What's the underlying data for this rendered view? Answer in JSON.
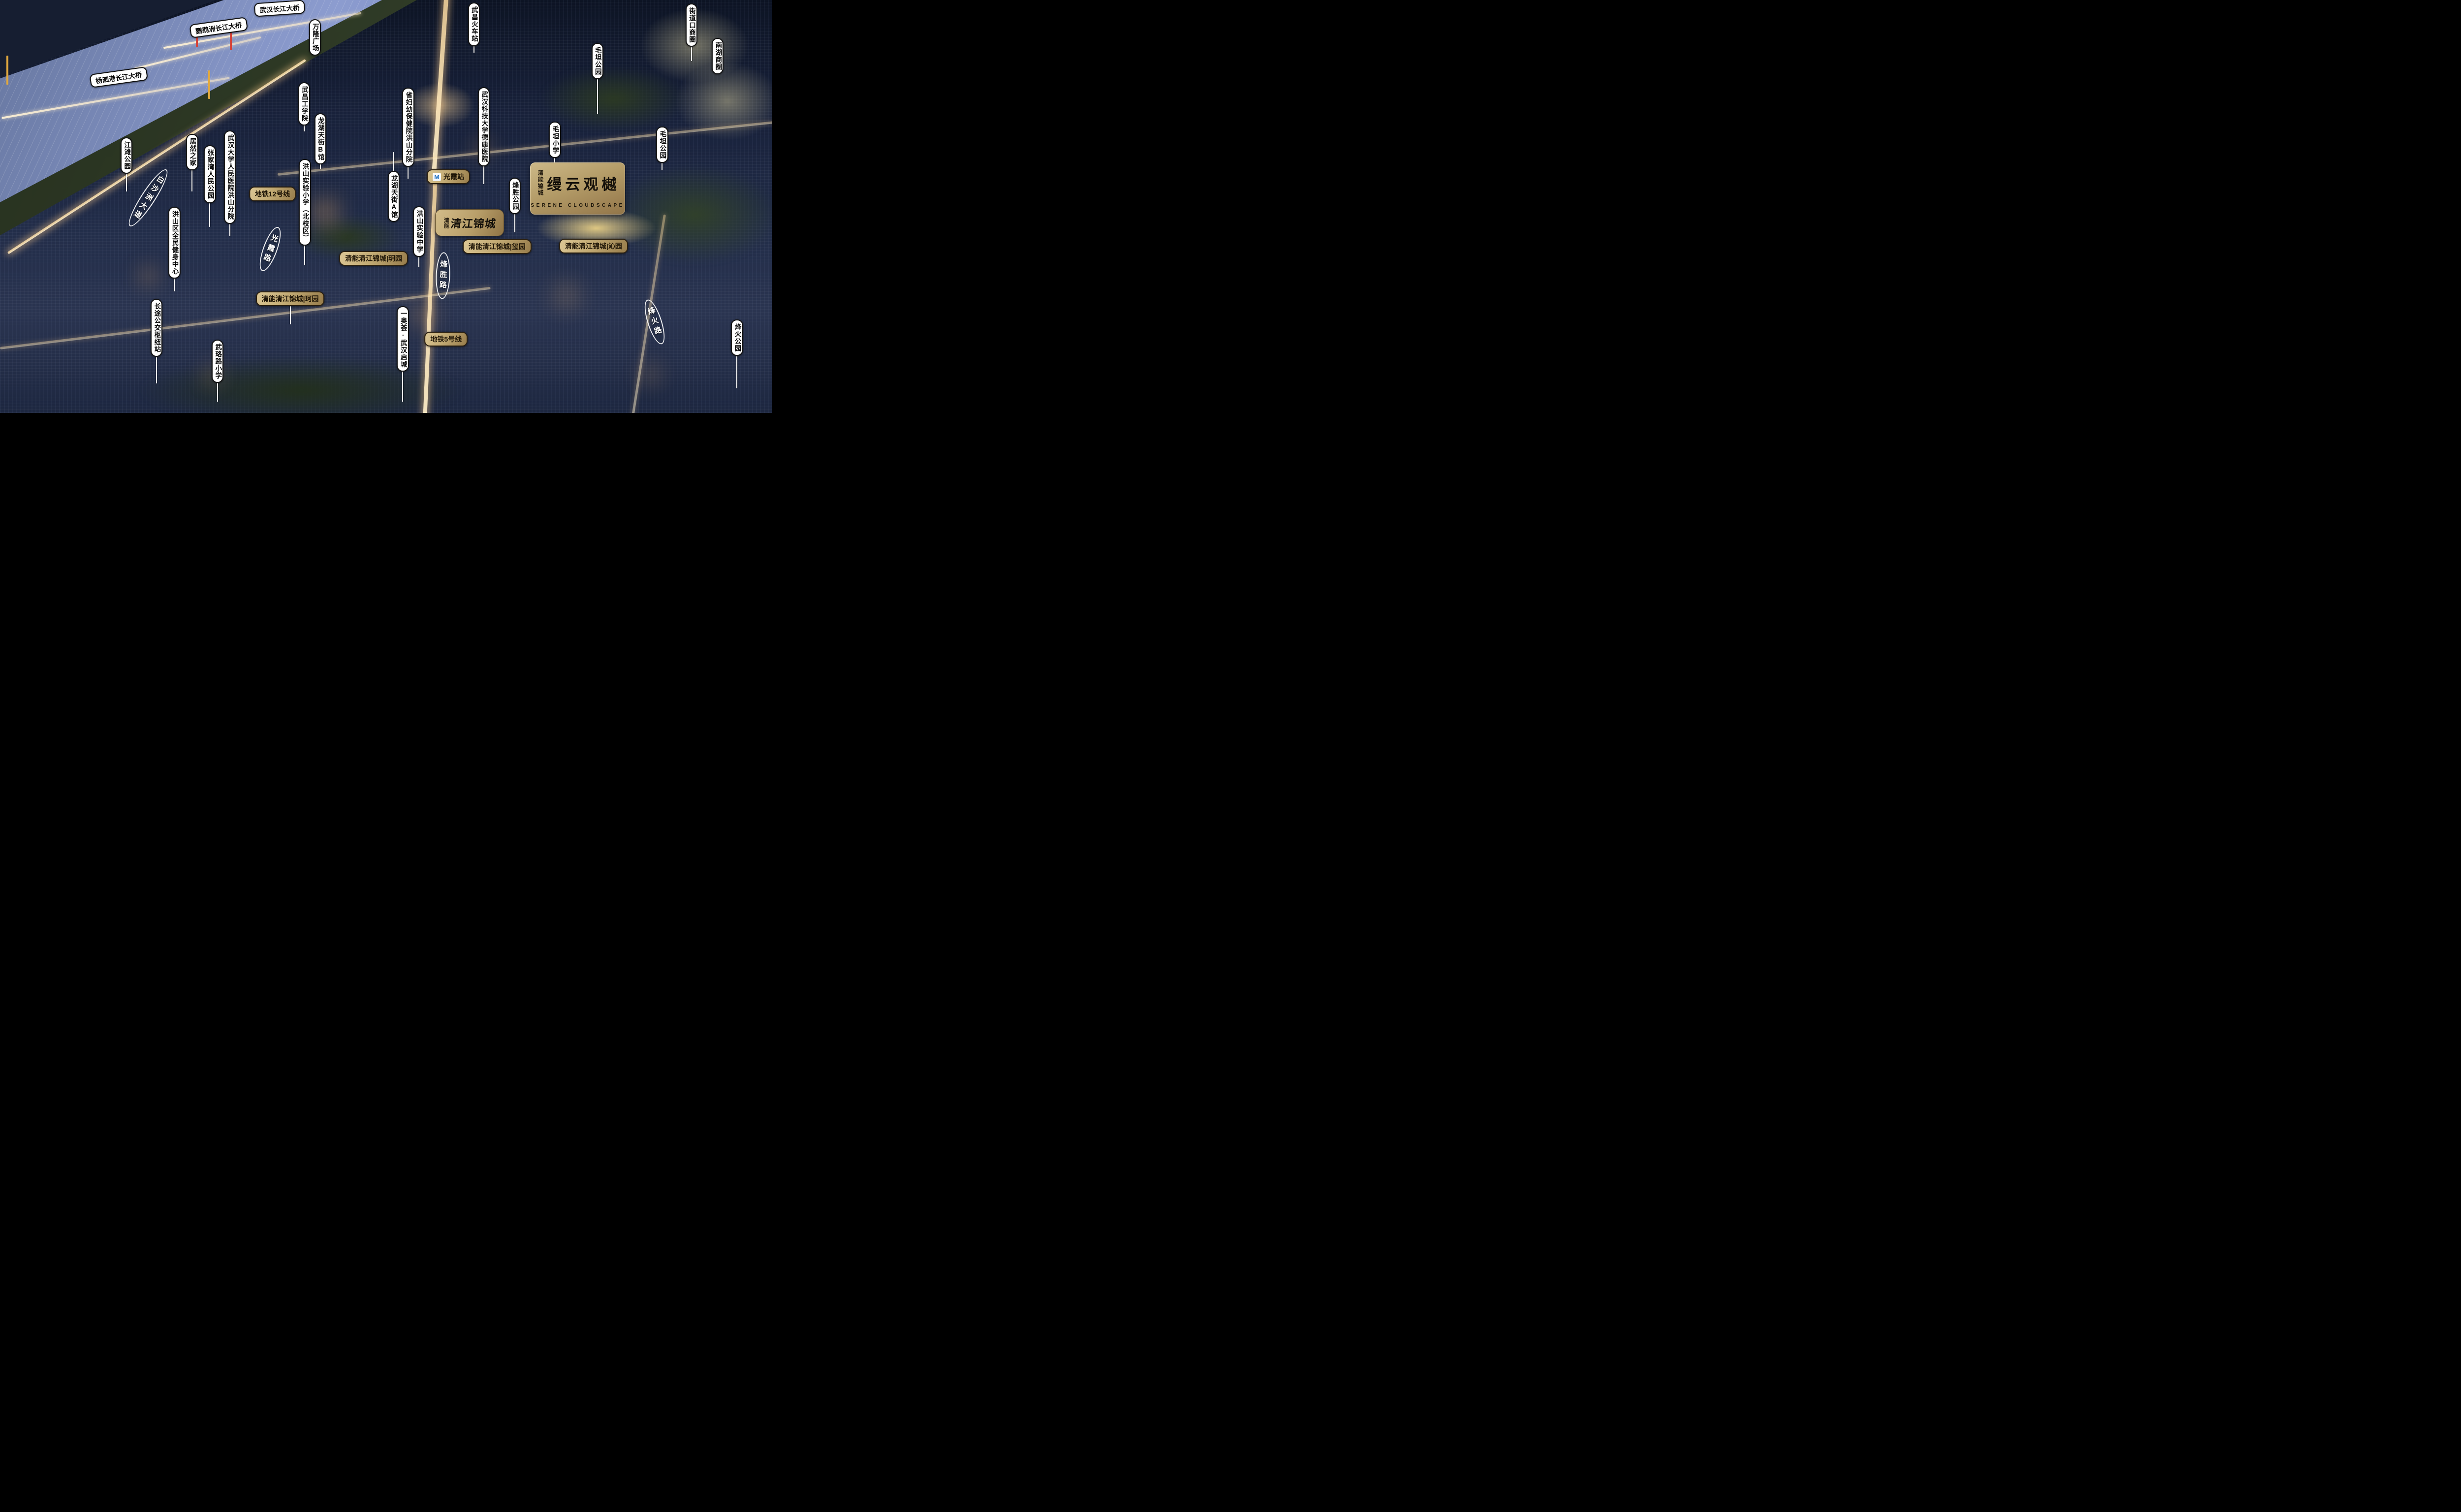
{
  "logo": {
    "seal": "清能锦城",
    "title": "缦云观樾",
    "subtitle": "SERENE CLOUDSCAPE"
  },
  "brand": {
    "prefix": "清能",
    "name": "清江锦城"
  },
  "colors": {
    "gold_light": "#dcc795",
    "gold_dark": "#977c4b",
    "pill_white": "#ffffff",
    "pill_text": "#050505",
    "metro_m_blue": "#1e6fc0",
    "road_text": "#ffffff",
    "night_city": "#1a2338",
    "river_blue": "#8c9ccf"
  },
  "metro_icon": "metro-m-icon",
  "map_labels": [
    {
      "id": "wuhan-changjiang-bridge",
      "kind": "place-h",
      "text": "武汉长江大桥",
      "x": 36.2,
      "y": 2.0,
      "rot": -4
    },
    {
      "id": "yingwuzhou-changjiang-bridge",
      "kind": "place-h",
      "text": "鹦鹉洲长江大桥",
      "x": 28.3,
      "y": 6.7,
      "rot": -8
    },
    {
      "id": "yangsigang-changjiang-bridge",
      "kind": "place-h",
      "text": "杨泗港长江大桥",
      "x": 15.4,
      "y": 18.7,
      "rot": -8
    },
    {
      "id": "wanlong-plaza",
      "kind": "place-v",
      "text": "万隆广场",
      "x": 40.8,
      "top": 4.6
    },
    {
      "id": "wuchang-railway-station",
      "kind": "place-v",
      "text": "武昌火车站",
      "x": 61.4,
      "top": 0.6,
      "leader": [
        10.9,
        12.8
      ]
    },
    {
      "id": "jiedaokou-business-circle",
      "kind": "place-v",
      "text": "街道口商圈",
      "x": 89.6,
      "top": 0.8,
      "leader": [
        11.1,
        14.8
      ]
    },
    {
      "id": "nanhu-business-circle",
      "kind": "place-v",
      "text": "南湖商圈",
      "x": 93.0,
      "top": 9.2
    },
    {
      "id": "maotan-park-north",
      "kind": "place-v",
      "text": "毛坦公园",
      "x": 77.4,
      "top": 10.4,
      "leader": [
        19.0,
        27.5
      ]
    },
    {
      "id": "maotan-primary-school",
      "kind": "place-v",
      "text": "毛坦小学",
      "x": 71.9,
      "top": 29.4,
      "leader": [
        38.0,
        41.3
      ]
    },
    {
      "id": "maotan-park-east",
      "kind": "place-v",
      "text": "毛坦公园",
      "x": 85.8,
      "top": 30.6,
      "leader": [
        39.2,
        41.3
      ]
    },
    {
      "id": "wuchang-institute-of-technology",
      "kind": "place-v",
      "text": "武昌工学院",
      "x": 39.4,
      "top": 19.9,
      "leader": [
        30.2,
        31.8
      ]
    },
    {
      "id": "longhu-paradise-walk-b",
      "kind": "place-v",
      "text": "龙湖天街B馆",
      "x": 41.5,
      "top": 27.4,
      "leader": [
        39.4,
        41.0
      ]
    },
    {
      "id": "provincial-maternity-hospital-hongshan",
      "kind": "place-v",
      "text": "省妇幼保健院洪山分院",
      "x": 52.9,
      "top": 21.2,
      "leader": [
        40.2,
        43.3
      ]
    },
    {
      "id": "wust-dekang-hospital",
      "kind": "place-v",
      "text": "武汉科技大学德康医院",
      "x": 62.7,
      "top": 21.1,
      "leader": [
        40.1,
        44.6
      ]
    },
    {
      "id": "jiangtan-park",
      "kind": "place-v",
      "text": "江滩公园",
      "x": 16.4,
      "top": 33.2,
      "leader": [
        41.8,
        46.4
      ]
    },
    {
      "id": "juran-home",
      "kind": "place-v",
      "text": "居然之家",
      "x": 24.9,
      "top": 32.4,
      "leader": [
        41.0,
        46.4
      ]
    },
    {
      "id": "zhangjiawan-peoples-park",
      "kind": "place-v",
      "text": "张家湾人民公园",
      "x": 27.2,
      "top": 35.2,
      "leader": [
        49.0,
        55.0
      ]
    },
    {
      "id": "wuhan-university-peoples-hospital-hongshan",
      "kind": "place-v",
      "text": "武汉大学人民医院洪山分院",
      "x": 29.8,
      "top": 31.6,
      "leader": [
        54.1,
        57.2
      ]
    },
    {
      "id": "hongshan-experimental-primary-north",
      "kind": "place-v",
      "text": "洪山实验小学（北校区）",
      "x": 39.5,
      "top": 38.5,
      "leader": [
        59.2,
        64.3
      ]
    },
    {
      "id": "longhu-paradise-walk-a",
      "kind": "place-v",
      "text": "龙湖天街A馆",
      "x": 51.0,
      "top": 41.3,
      "leader": [
        36.8,
        41.3
      ]
    },
    {
      "id": "hongshan-experimental-middle-school",
      "kind": "place-v",
      "text": "洪山实验中学",
      "x": 54.3,
      "top": 49.9,
      "leader": [
        61.9,
        64.6
      ]
    },
    {
      "id": "fengsheng-park",
      "kind": "place-v",
      "text": "烽胜公园",
      "x": 66.7,
      "top": 43.0,
      "leader": [
        51.6,
        56.2
      ]
    },
    {
      "id": "hongshan-fitness-center",
      "kind": "place-v",
      "text": "洪山区全民健身中心",
      "x": 22.6,
      "top": 50.0,
      "leader": [
        67.3,
        70.6
      ]
    },
    {
      "id": "long-distance-bus-hub",
      "kind": "place-v",
      "text": "长途公交枢纽站",
      "x": 20.3,
      "top": 72.4,
      "leader": [
        86.2,
        92.8
      ]
    },
    {
      "id": "wuluo-road-primary-school",
      "kind": "place-v",
      "text": "武珞路小学",
      "x": 28.2,
      "top": 82.2,
      "leader": [
        92.5,
        97.3
      ]
    },
    {
      "id": "aohui-wuhan-qicheng",
      "kind": "place-v",
      "text": "一奥荟·武汉启城",
      "x": 52.2,
      "top": 74.1,
      "leader": [
        89.6,
        97.3
      ]
    },
    {
      "id": "fenghuo-park",
      "kind": "place-v",
      "text": "烽火公园",
      "x": 95.5,
      "top": 77.3,
      "leader": [
        85.9,
        94.0
      ]
    },
    {
      "id": "metro-line-12",
      "kind": "gold",
      "text": "地铁12号线",
      "x": 35.3,
      "y": 47.0
    },
    {
      "id": "metro-line-5",
      "kind": "gold",
      "text": "地铁5号线",
      "x": 57.8,
      "y": 82.1
    },
    {
      "id": "guangxia-metro-station",
      "kind": "gold",
      "text": "光霞站",
      "x": 58.1,
      "y": 42.8,
      "metro": true
    },
    {
      "id": "qingjiang-jincheng-xi-garden",
      "kind": "gold",
      "text": "清能清江锦城|玺园",
      "x": 64.4,
      "y": 59.7
    },
    {
      "id": "qingjiang-jincheng-qin-garden",
      "kind": "gold",
      "text": "清能清江锦城|沁园",
      "x": 76.9,
      "y": 59.6
    },
    {
      "id": "qingjiang-jincheng-yue-garden",
      "kind": "gold",
      "text": "清能清江锦城|玥园",
      "x": 48.4,
      "y": 62.6
    },
    {
      "id": "qingjiang-jincheng-ke-garden",
      "kind": "gold",
      "text": "清能清江锦城|珂园",
      "x": 37.6,
      "y": 72.3,
      "leader": [
        74.0,
        78.5
      ]
    },
    {
      "id": "baishazhou-avenue",
      "kind": "road-v",
      "text": "白沙洲大道",
      "x": 19.2,
      "y": 47.9,
      "rot": 33
    },
    {
      "id": "guangxia-road",
      "kind": "road-v",
      "text": "光霞路",
      "x": 35.0,
      "y": 60.3,
      "rot": 20
    },
    {
      "id": "fengsheng-road",
      "kind": "road-v",
      "text": "烽胜路",
      "x": 57.4,
      "y": 66.7,
      "rot": 2
    },
    {
      "id": "fenghuo-road",
      "kind": "road-v",
      "text": "烽火路",
      "x": 84.8,
      "y": 78.0,
      "rot": -18
    }
  ]
}
